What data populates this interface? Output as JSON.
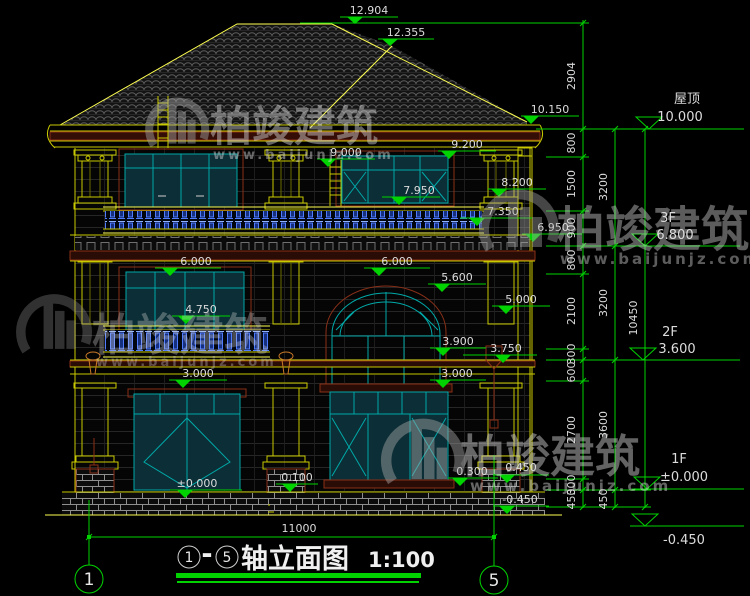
{
  "watermark": {
    "brand": "柏竣建筑",
    "url": "www.baijunjz.com"
  },
  "title_block": {
    "axis_from": "1",
    "dash": "-",
    "axis_to": "5",
    "name": "轴立面图",
    "scale": "1:100"
  },
  "axes": {
    "left": "1",
    "right": "5"
  },
  "bottom_dim": "11000",
  "levels": {
    "roof_label": "屋顶",
    "roof_value": "10.000",
    "f3_label": "3F",
    "f3_value": "6.800",
    "f2_label": "2F",
    "f2_value": "3.600",
    "f1_label": "1F",
    "f1_value": "±0.000",
    "ground_value": "-0.450"
  },
  "markers": {
    "m12904": "12.904",
    "m12355": "12.355",
    "m10150": "10.150",
    "m9200": "9.200",
    "m9000": "9.000",
    "m8200": "8.200",
    "m7950": "7.950",
    "m7350": "7.350",
    "m6950": "6.950",
    "m6000_left": "6.000",
    "m6000_right": "6.000",
    "m5600": "5.600",
    "m5000": "5.000",
    "m4750": "4.750",
    "m3900": "3.900",
    "m3750": "3.750",
    "m3000_left": "3.000",
    "m3000_right": "3.000",
    "m0100": "0.100",
    "m0000": "±0.000",
    "m0300": "0.300",
    "m0450": "0.450",
    "mn0450": "-0.450"
  },
  "dims": {
    "top_right": "2904",
    "chain1": [
      "800",
      "1500",
      "900",
      "800",
      "2100",
      "300",
      "600",
      "2700",
      "300",
      "450"
    ],
    "chain2": [
      "3200",
      "3200",
      "3600",
      "450"
    ],
    "total": "10450"
  },
  "colors": {
    "dim_green": "#00d300",
    "line_yellow": "#c9c900",
    "frame_teal": "#00a8a8",
    "trim_maroon": "#8a3018",
    "baluster_blue": "#4f7bff"
  }
}
